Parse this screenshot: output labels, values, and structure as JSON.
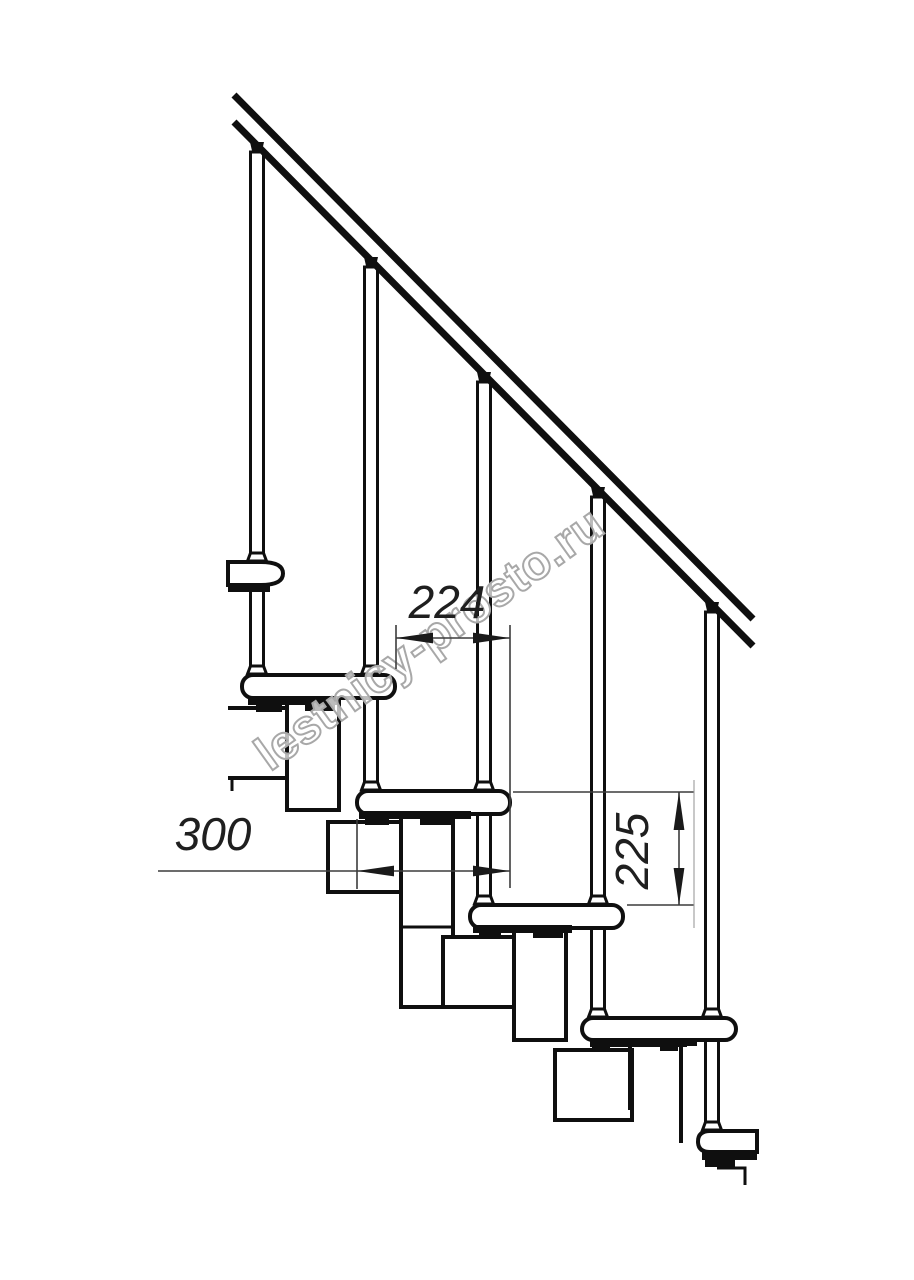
{
  "watermark": {
    "text": "lestnicy-prosto.ru",
    "color": "#a8a8a8"
  },
  "dimensions": {
    "step_run": {
      "value": "224"
    },
    "tread_depth": {
      "value": "300"
    },
    "step_rise": {
      "value": "225"
    }
  },
  "colors": {
    "ink": "#0f0f0f",
    "dimension": "#3c3c3c",
    "watermark": "#a8a8a8",
    "background": "#ffffff"
  }
}
